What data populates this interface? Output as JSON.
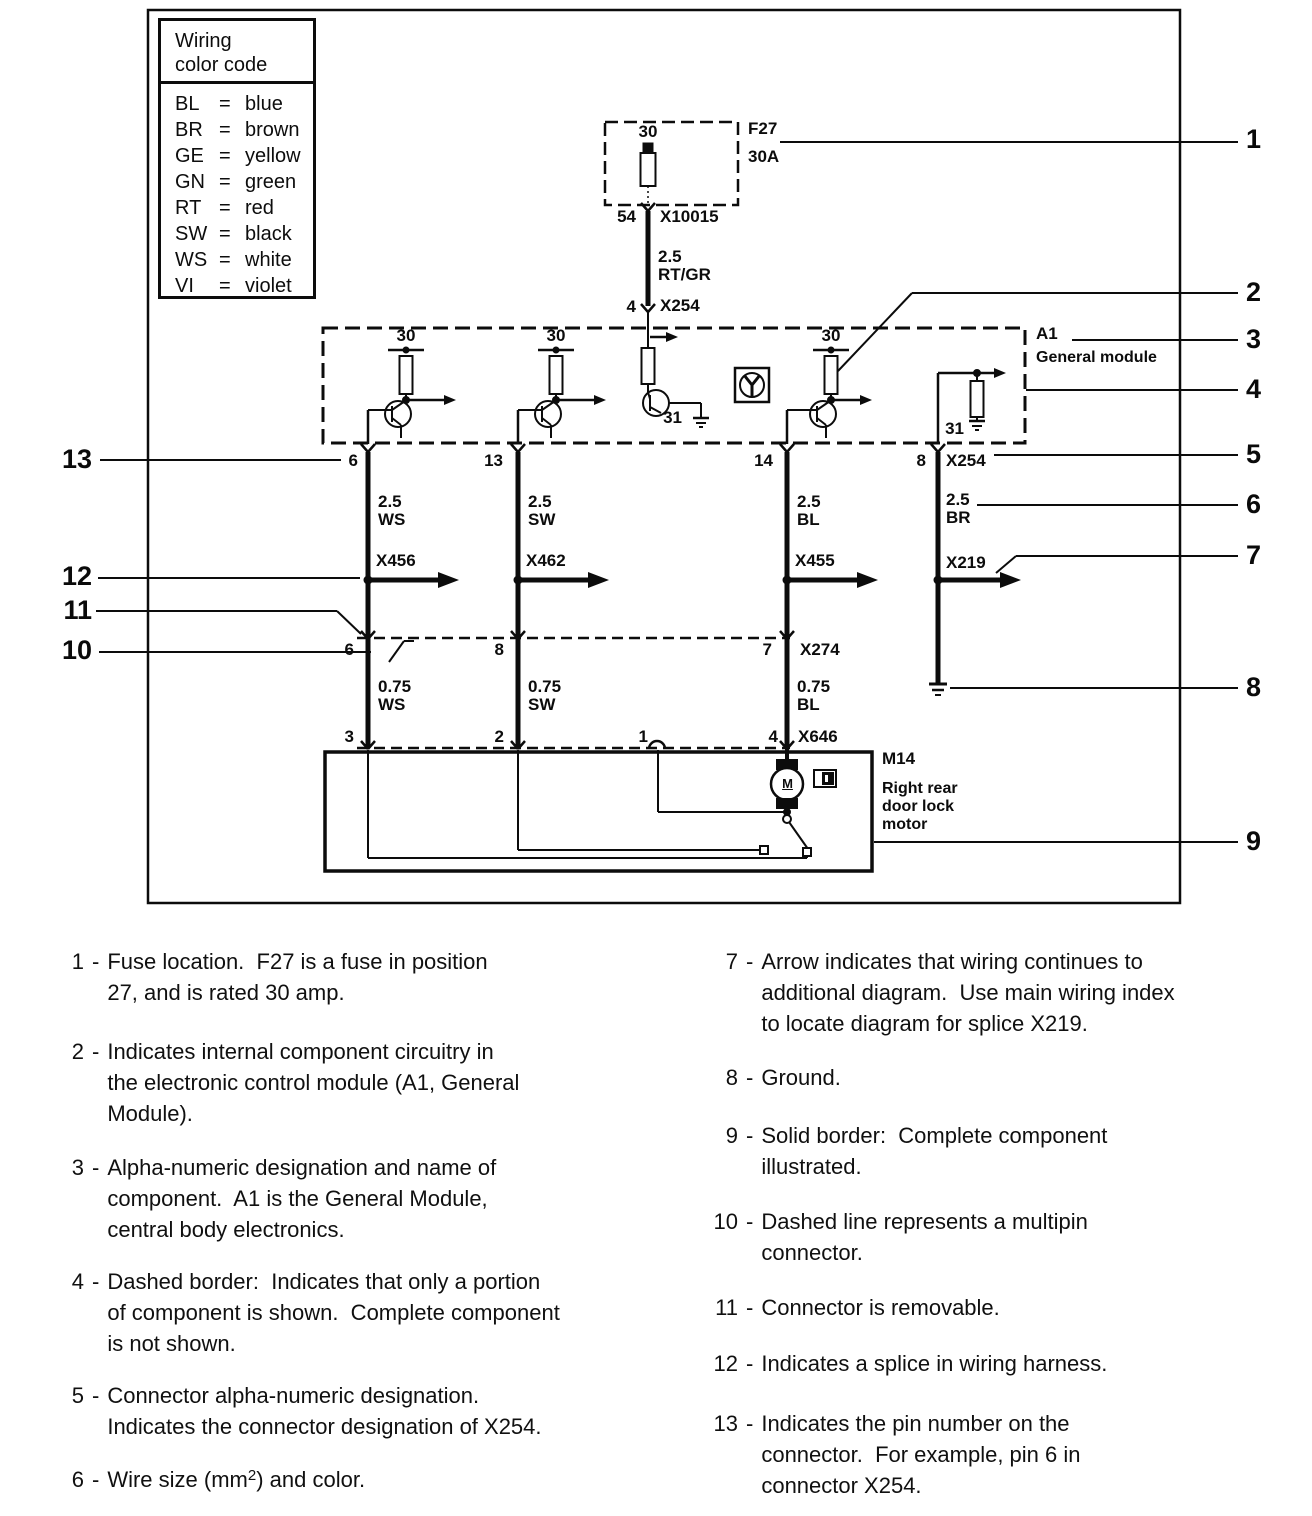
{
  "legend": {
    "title_line1": "Wiring",
    "title_line2": "color code",
    "eq": "=",
    "entries": [
      {
        "code": "BL",
        "name": "blue"
      },
      {
        "code": "BR",
        "name": "brown"
      },
      {
        "code": "GE",
        "name": "yellow"
      },
      {
        "code": "GN",
        "name": "green"
      },
      {
        "code": "RT",
        "name": "red"
      },
      {
        "code": "SW",
        "name": "black"
      },
      {
        "code": "WS",
        "name": "white"
      },
      {
        "code": "VI",
        "name": "violet"
      }
    ]
  },
  "diagram": {
    "fuse": {
      "bus": "30",
      "id": "F27",
      "rating": "30A",
      "pin": "54",
      "conn": "X10015",
      "size": "2.5",
      "color": "RT/GR",
      "pin_out": "4",
      "conn_out": "X254"
    },
    "module": {
      "id": "A1",
      "name": "General module",
      "bus_a": "30",
      "bus_b": "30",
      "bus_c": "30",
      "gnd_c": "31",
      "gnd_e": "31",
      "pin_a": "6",
      "pin_b": "13",
      "pin_c": "14",
      "pin_d": "8",
      "conn": "X254"
    },
    "upper_wires": [
      {
        "size": "2.5",
        "color": "WS"
      },
      {
        "size": "2.5",
        "color": "SW"
      },
      {
        "size": "2.5",
        "color": "BL"
      },
      {
        "size": "2.5",
        "color": "BR"
      }
    ],
    "splices": [
      "X456",
      "X462",
      "X455",
      "X219"
    ],
    "x274": {
      "id": "X274",
      "pins": [
        "6",
        "8",
        "7"
      ]
    },
    "lower_wires": [
      {
        "size": "0.75",
        "color": "WS"
      },
      {
        "size": "0.75",
        "color": "SW"
      },
      {
        "size": "0.75",
        "color": "BL"
      }
    ],
    "x646": {
      "id": "X646",
      "pins": [
        "3",
        "2",
        "1",
        "4"
      ]
    },
    "motor": {
      "id": "M14",
      "name1": "Right rear",
      "name2": "door lock",
      "name3": "motor",
      "letter": "M"
    }
  },
  "callouts": {
    "left": [
      "13",
      "12",
      "11",
      "10"
    ],
    "right": [
      "1",
      "2",
      "3",
      "4",
      "5",
      "6",
      "7",
      "8",
      "9"
    ]
  },
  "notes": {
    "left": [
      {
        "num": "1",
        "lines": [
          "Fuse location.  F27 is a fuse in position",
          "27, and is rated 30 amp."
        ]
      },
      {
        "num": "2",
        "lines": [
          "Indicates internal component circuitry in",
          "the electronic control module (A1, General",
          "Module)."
        ]
      },
      {
        "num": "3",
        "lines": [
          "Alpha-numeric designation and name of",
          "component.  A1 is the General Module,",
          "central body electronics."
        ]
      },
      {
        "num": "4",
        "lines": [
          "Dashed border:  Indicates that only a portion",
          "of component is shown.  Complete component",
          "is not shown."
        ]
      },
      {
        "num": "5",
        "lines": [
          "Connector alpha-numeric designation.",
          "Indicates the connector designation of X254."
        ]
      },
      {
        "num": "6",
        "pre": "Wire size (mm",
        "sup": "2",
        "post": ") and color."
      }
    ],
    "right": [
      {
        "num": "7",
        "lines": [
          "Arrow indicates that wiring continues to",
          "additional diagram.  Use main wiring index",
          "to locate diagram for splice X219."
        ]
      },
      {
        "num": "8",
        "lines": [
          "Ground."
        ]
      },
      {
        "num": "9",
        "lines": [
          "Solid border:  Complete component",
          "illustrated."
        ]
      },
      {
        "num": "10",
        "lines": [
          "Dashed line represents a multipin",
          "connector."
        ]
      },
      {
        "num": "11",
        "lines": [
          "Connector is removable."
        ]
      },
      {
        "num": "12",
        "lines": [
          "Indicates a splice in wiring harness."
        ]
      },
      {
        "num": "13",
        "lines": [
          "Indicates the pin number on the",
          "connector.  For example, pin 6 in",
          "connector X254."
        ]
      }
    ]
  }
}
